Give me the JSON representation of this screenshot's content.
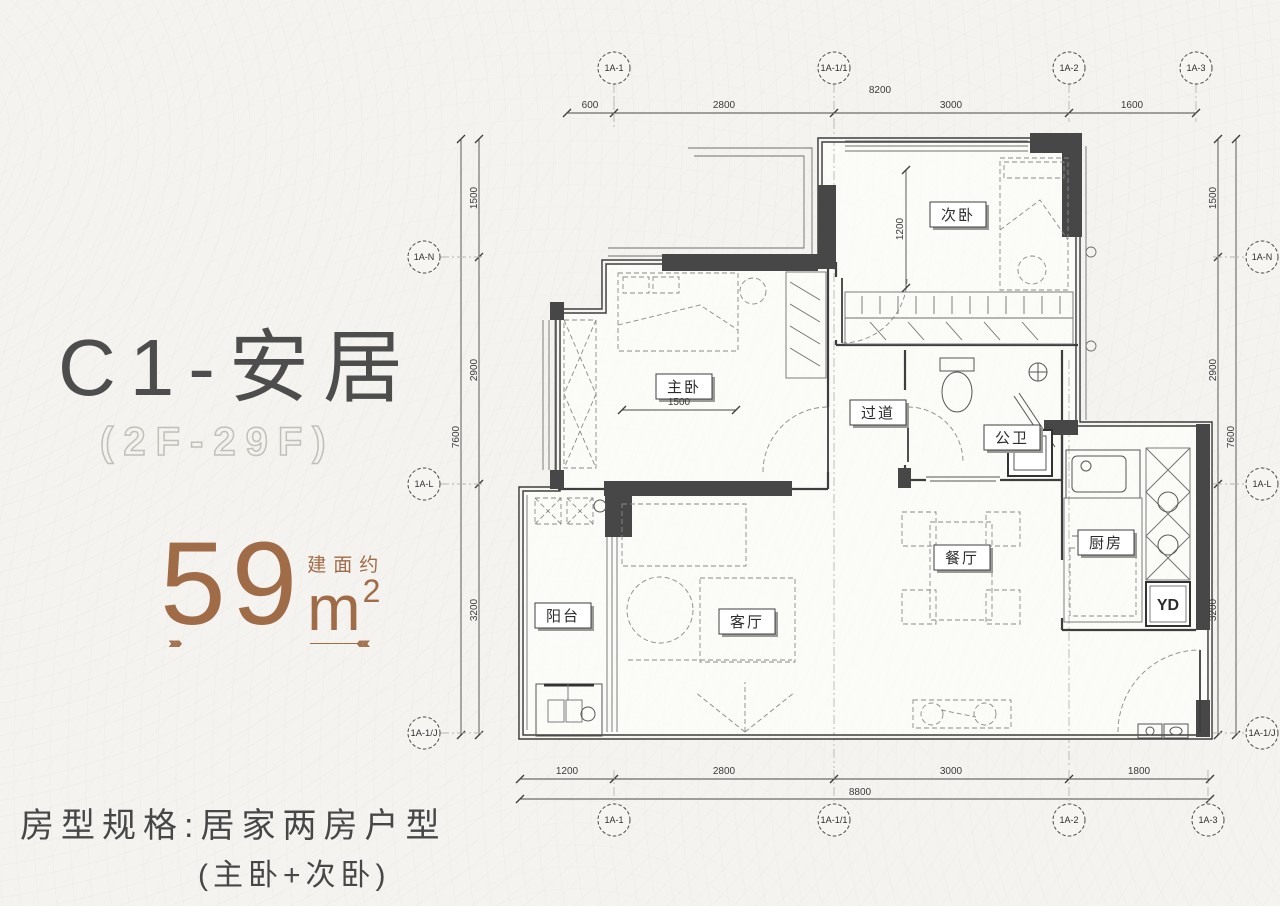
{
  "branding": {
    "unit_name": "C1-安居",
    "floor_range": "(2F-29F)",
    "area": {
      "label": "建面约",
      "value": "59",
      "unit": "m",
      "exponent": "2"
    },
    "deco_left_arrows": "››››",
    "deco_right_arrows": "‹‹‹‹",
    "spec_line1": "房型规格:居家两房户型",
    "spec_line2": "(主卧+次卧)"
  },
  "colors": {
    "background": "#f4f3f0",
    "accent_brown": "#a06b47",
    "heading_gray": "#4d4d4d",
    "wall_dark": "#474747"
  },
  "floorplan": {
    "room_labels": {
      "bedroom2": "次卧",
      "bedroom1": "主卧",
      "hallway": "过道",
      "bath": "公卫",
      "kitchen": "厨房",
      "dining": "餐厅",
      "living": "客厅",
      "balcony": "阳台",
      "yd": "YD"
    },
    "inner_dims": {
      "bedroom2_width": "1200",
      "bedroom1_width": "1500"
    },
    "axes": {
      "top": [
        "1A-1",
        "1A-1/1",
        "1A-2",
        "1A-3"
      ],
      "bottom": [
        "1A-1",
        "1A-1/1",
        "1A-2",
        "1A-3"
      ],
      "left": [
        "1A-N",
        "1A-L",
        "1A-1/J"
      ],
      "right": [
        "1A-N",
        "1A-L",
        "1A-1/J"
      ]
    },
    "dims": {
      "top": [
        "600",
        "2800",
        "3000",
        "1600"
      ],
      "top_total": "8200",
      "bottom": [
        "1200",
        "2800",
        "3000",
        "1800"
      ],
      "bottom_total": "8800",
      "left": [
        "1500",
        "2900",
        "3200"
      ],
      "left_total": "7600",
      "right": [
        "1500",
        "2900",
        "3200"
      ],
      "right_total": "7600"
    }
  }
}
